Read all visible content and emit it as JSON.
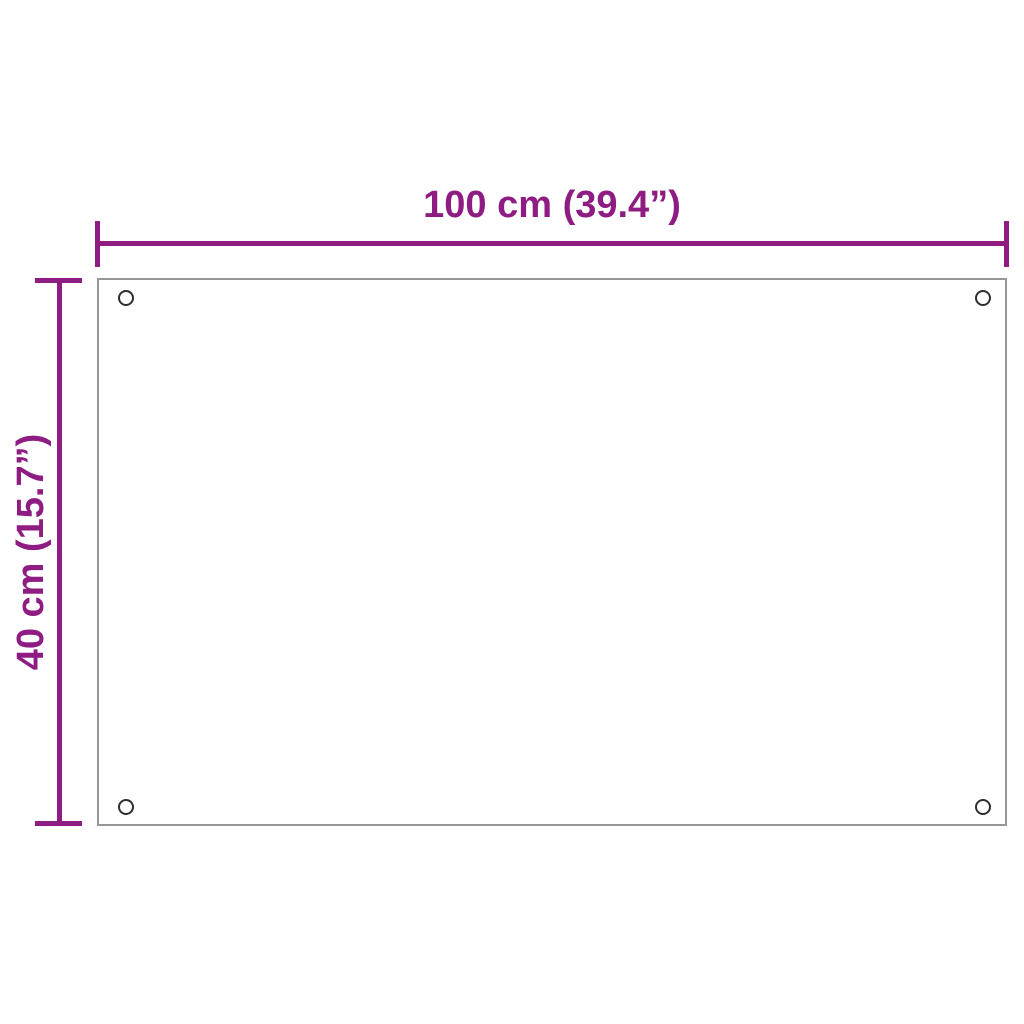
{
  "diagram": {
    "kind": "product-dimension-diagram",
    "dimensions": {
      "width": {
        "label": "100 cm (39.4”)"
      },
      "height": {
        "label": "40 cm (15.7”)"
      }
    },
    "panel": {
      "holes": [
        "top-left",
        "top-right",
        "bottom-left",
        "bottom-right"
      ]
    }
  },
  "colors": {
    "dimension-accent": "#8E1C82",
    "panel-border": "#969696",
    "hole-border": "#2E2E2E",
    "background": "#FFFFFF"
  }
}
